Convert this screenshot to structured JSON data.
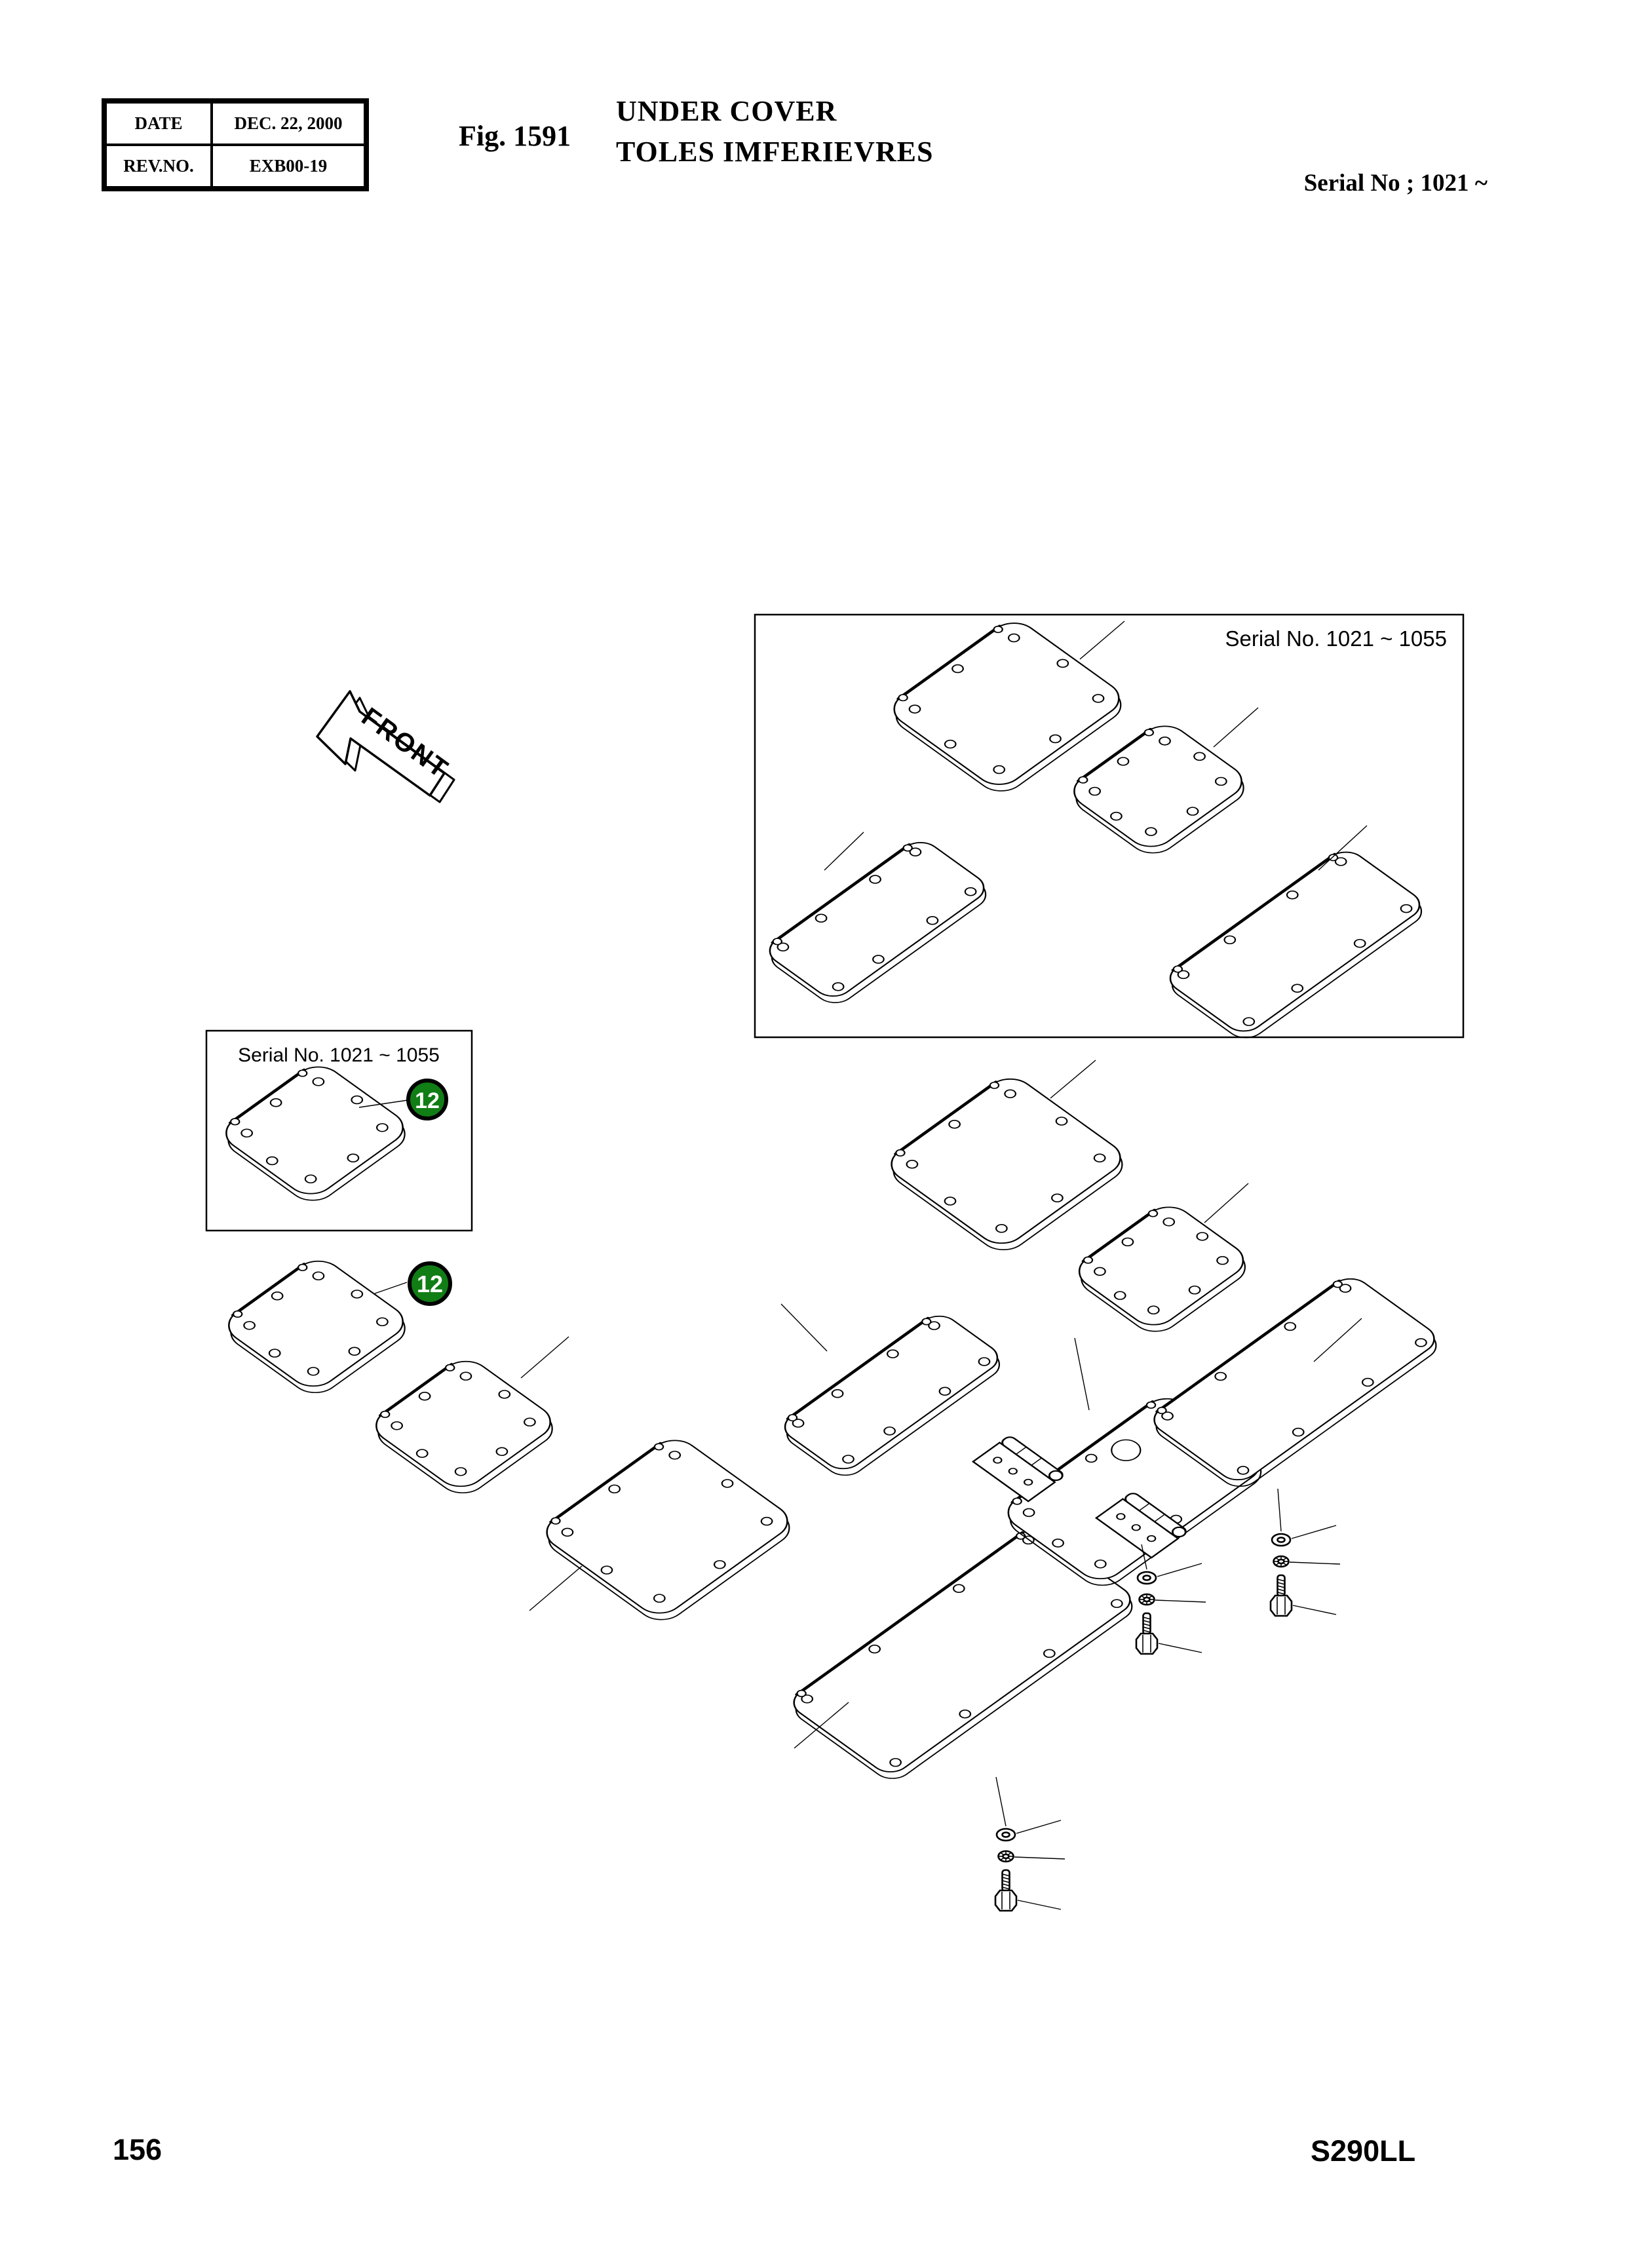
{
  "header": {
    "date_label": "DATE",
    "date_value": "DEC. 22, 2000",
    "rev_label": "REV.NO.",
    "rev_value": "EXB00-19",
    "figure_label": "Fig. 1591",
    "title_line1": "UNDER COVER",
    "title_line2": "TOLES IMFERIEVRES",
    "serial_note": "Serial No ; 1021 ~"
  },
  "diagram": {
    "front_label": "FRONT",
    "inset_top_label": "Serial No. 1021 ~ 1055",
    "inset_left_label": "Serial No. 1021 ~ 1055",
    "callout_number": "12",
    "callout_color": "#117d15"
  },
  "footer": {
    "page_number": "156",
    "model_code": "S290LL"
  }
}
